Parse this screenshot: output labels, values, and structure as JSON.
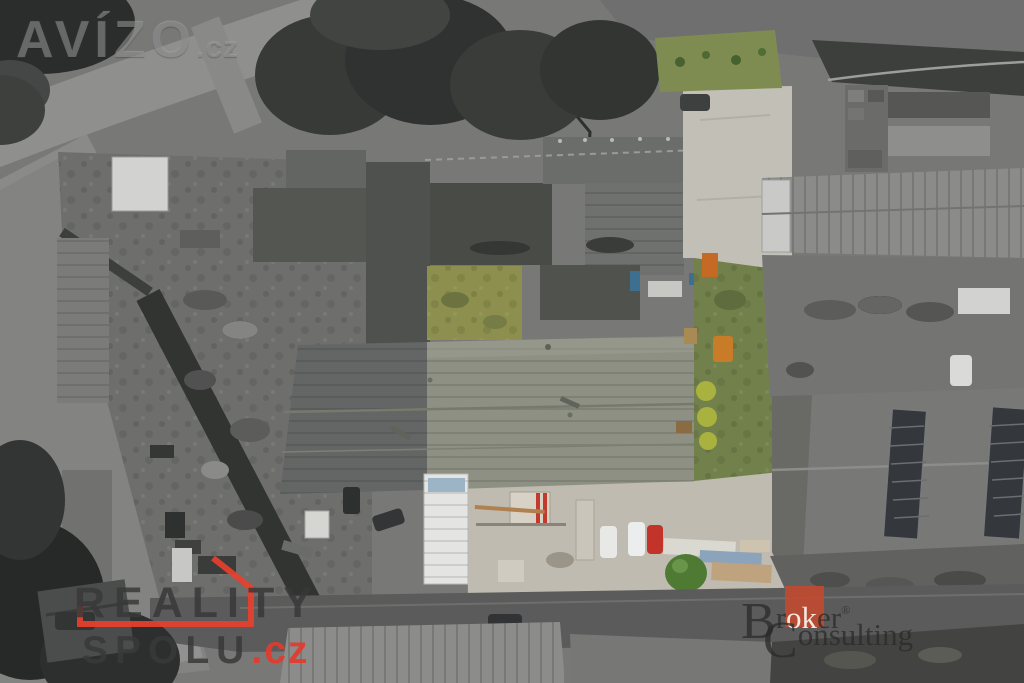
{
  "image": {
    "kind": "aerial-drone-photo",
    "subject": "industrial real-estate parcel highlighted in color amid desaturated surroundings",
    "width_px": 1024,
    "height_px": 683
  },
  "watermarks": {
    "avizo": {
      "name": "AVÍZO",
      "tld": ".cz"
    },
    "reality_spolu": {
      "line1": "REALITY",
      "line2": "SPOLU",
      "tld": ".cz",
      "accent_color": "#e8402e",
      "text_color": "#383838"
    },
    "broker_consulting": {
      "b": "B",
      "r": "r",
      "ok": "ok",
      "er": "er",
      "reg": "®",
      "c": "C",
      "onsulting": "onsulting",
      "square_color": "#bf4a30"
    }
  },
  "palette": {
    "hall_roof_color": "#8d9083",
    "hall_roof_gray": "#646665",
    "courtyard_grass": "#8c8f4d",
    "lawn_green": "#72804b",
    "top_grass": "#7f8c51",
    "driveway_beige": "#c2bfb6",
    "south_yard_beige": "#c0bbb0",
    "asphalt_dark": "#5a5b5a",
    "bush_yellow_green": "#a9b23e",
    "bottom_bush_green": "#4e7a33",
    "red_car": "#c2332a",
    "orange_equipment": "#c56a25"
  },
  "scene_elements": [
    {
      "name": "main-hall-roof",
      "note": "large gable roof, right half in color (grey-green), left half desaturated"
    },
    {
      "name": "courtyard-grass",
      "note": "inner yard with dry green grass"
    },
    {
      "name": "side-lawn",
      "note": "lawn with three yellow-green shrubs and picnic table"
    },
    {
      "name": "driveway",
      "note": "beige concrete access road along east side of parcel"
    },
    {
      "name": "white-outbuilding",
      "note": "small white ribbed-roof building at south-west of hall"
    },
    {
      "name": "parked-vehicles",
      "note": "two white vans and one red car in south yard"
    },
    {
      "name": "material-stacks",
      "note": "pallets and packaged building material in south yard"
    },
    {
      "name": "orange-excavator",
      "note": "small orange machines near east wall"
    },
    {
      "name": "neighbour-halls",
      "note": "desaturated industrial halls left, right and top"
    },
    {
      "name": "roads",
      "note": "street along bottom edge and junction top-left, desaturated"
    },
    {
      "name": "tree-clusters",
      "note": "dark tree canopies top-centre, bottom-left"
    }
  ]
}
